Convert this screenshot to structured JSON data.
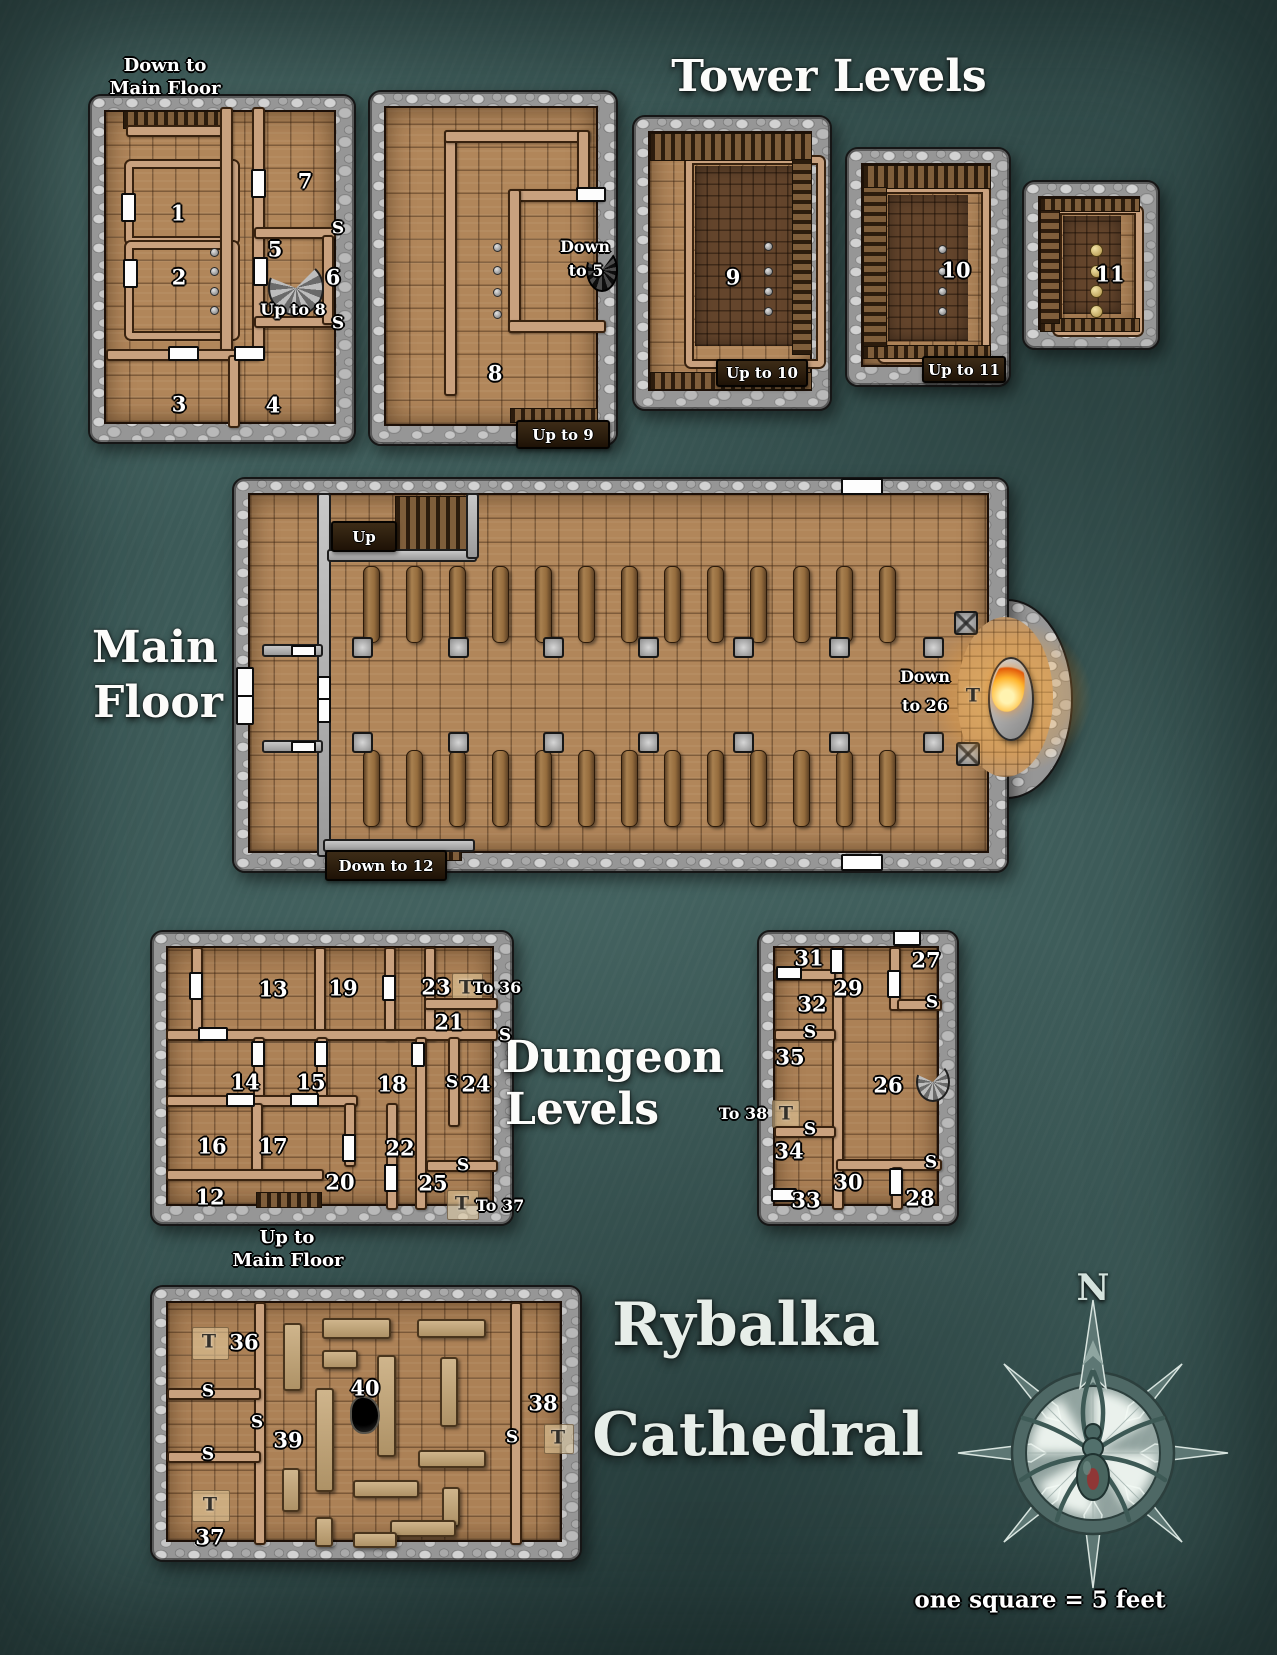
{
  "titles": {
    "tower_levels": "Tower Levels",
    "main_floor": [
      "Main",
      "Floor"
    ],
    "dungeon_levels": [
      "Dungeon",
      "Levels"
    ],
    "map_name": [
      "Rybalka",
      "Cathedral"
    ],
    "compass_north": "N",
    "scale_note": "one square = 5 feet"
  },
  "captions": {
    "tower1_above": [
      "Down to",
      "Main Floor"
    ],
    "dungeon_a_below": [
      "Up to",
      "Main Floor"
    ]
  },
  "banners": {
    "up": "Up",
    "down_to_12": "Down to 12",
    "up_to_9": "Up to 9",
    "up_to_10": "Up to 10",
    "up_to_11": "Up to 11"
  },
  "colors": {
    "background_teal": "#3c5a58",
    "stone_gray": "#969696",
    "floor_wood": "#b1865a",
    "interior_wall": "#c9a17e",
    "door_white": "#fdfdfd",
    "flame_orange": "#ffb52e"
  },
  "labels": [
    {
      "t": "1",
      "x": 178,
      "y": 213,
      "k": "num"
    },
    {
      "t": "2",
      "x": 179,
      "y": 277,
      "k": "num"
    },
    {
      "t": "3",
      "x": 179,
      "y": 404,
      "k": "num"
    },
    {
      "t": "4",
      "x": 273,
      "y": 405,
      "k": "num"
    },
    {
      "t": "5",
      "x": 275,
      "y": 249,
      "k": "num"
    },
    {
      "t": "6",
      "x": 333,
      "y": 277,
      "k": "num"
    },
    {
      "t": "7",
      "x": 305,
      "y": 181,
      "k": "num"
    },
    {
      "t": "Up to 8",
      "x": 293,
      "y": 310,
      "k": "cap"
    },
    {
      "t": "S",
      "x": 338,
      "y": 229,
      "k": "s"
    },
    {
      "t": "S",
      "x": 338,
      "y": 324,
      "k": "s"
    },
    {
      "t": "8",
      "x": 495,
      "y": 373,
      "k": "num"
    },
    {
      "t": "Down",
      "x": 585,
      "y": 247,
      "k": "cap"
    },
    {
      "t": "to 5",
      "x": 586,
      "y": 271,
      "k": "cap"
    },
    {
      "t": "9",
      "x": 733,
      "y": 277,
      "k": "num"
    },
    {
      "t": "10",
      "x": 956,
      "y": 270,
      "k": "num"
    },
    {
      "t": "11",
      "x": 1110,
      "y": 274,
      "k": "num"
    },
    {
      "t": "Down",
      "x": 925,
      "y": 677,
      "k": "cap"
    },
    {
      "t": "to 26",
      "x": 925,
      "y": 706,
      "k": "cap"
    },
    {
      "t": "T",
      "x": 973,
      "y": 696,
      "k": "t"
    },
    {
      "t": "13",
      "x": 273,
      "y": 989,
      "k": "num"
    },
    {
      "t": "19",
      "x": 343,
      "y": 988,
      "k": "num"
    },
    {
      "t": "23",
      "x": 436,
      "y": 987,
      "k": "num"
    },
    {
      "t": "T",
      "x": 466,
      "y": 988,
      "k": "t"
    },
    {
      "t": "To 36",
      "x": 497,
      "y": 988,
      "k": "cap"
    },
    {
      "t": "21",
      "x": 449,
      "y": 1022,
      "k": "num"
    },
    {
      "t": "S",
      "x": 505,
      "y": 1036,
      "k": "s"
    },
    {
      "t": "14",
      "x": 245,
      "y": 1082,
      "k": "num"
    },
    {
      "t": "15",
      "x": 311,
      "y": 1082,
      "k": "num"
    },
    {
      "t": "18",
      "x": 392,
      "y": 1084,
      "k": "num"
    },
    {
      "t": "S",
      "x": 452,
      "y": 1083,
      "k": "s"
    },
    {
      "t": "24",
      "x": 476,
      "y": 1084,
      "k": "num"
    },
    {
      "t": "16",
      "x": 212,
      "y": 1146,
      "k": "num"
    },
    {
      "t": "17",
      "x": 273,
      "y": 1146,
      "k": "num"
    },
    {
      "t": "22",
      "x": 400,
      "y": 1148,
      "k": "num"
    },
    {
      "t": "20",
      "x": 340,
      "y": 1182,
      "k": "num"
    },
    {
      "t": "25",
      "x": 433,
      "y": 1183,
      "k": "num"
    },
    {
      "t": "S",
      "x": 463,
      "y": 1166,
      "k": "s"
    },
    {
      "t": "12",
      "x": 210,
      "y": 1197,
      "k": "num"
    },
    {
      "t": "T",
      "x": 462,
      "y": 1204,
      "k": "t"
    },
    {
      "t": "To 37",
      "x": 500,
      "y": 1206,
      "k": "cap"
    },
    {
      "t": "31",
      "x": 809,
      "y": 958,
      "k": "num"
    },
    {
      "t": "27",
      "x": 926,
      "y": 960,
      "k": "num"
    },
    {
      "t": "29",
      "x": 848,
      "y": 988,
      "k": "num"
    },
    {
      "t": "32",
      "x": 812,
      "y": 1004,
      "k": "num"
    },
    {
      "t": "S",
      "x": 932,
      "y": 1003,
      "k": "s"
    },
    {
      "t": "S",
      "x": 810,
      "y": 1033,
      "k": "s"
    },
    {
      "t": "35",
      "x": 790,
      "y": 1057,
      "k": "num"
    },
    {
      "t": "26",
      "x": 888,
      "y": 1085,
      "k": "num"
    },
    {
      "t": "To 38",
      "x": 743,
      "y": 1114,
      "k": "cap"
    },
    {
      "t": "T",
      "x": 786,
      "y": 1114,
      "k": "t"
    },
    {
      "t": "S",
      "x": 810,
      "y": 1130,
      "k": "s"
    },
    {
      "t": "34",
      "x": 789,
      "y": 1151,
      "k": "num"
    },
    {
      "t": "30",
      "x": 848,
      "y": 1182,
      "k": "num"
    },
    {
      "t": "S",
      "x": 931,
      "y": 1163,
      "k": "s"
    },
    {
      "t": "33",
      "x": 806,
      "y": 1200,
      "k": "num"
    },
    {
      "t": "28",
      "x": 920,
      "y": 1198,
      "k": "num"
    },
    {
      "t": "T",
      "x": 209,
      "y": 1342,
      "k": "t"
    },
    {
      "t": "36",
      "x": 244,
      "y": 1342,
      "k": "num"
    },
    {
      "t": "S",
      "x": 208,
      "y": 1392,
      "k": "s"
    },
    {
      "t": "S",
      "x": 257,
      "y": 1423,
      "k": "s"
    },
    {
      "t": "39",
      "x": 288,
      "y": 1440,
      "k": "num"
    },
    {
      "t": "40",
      "x": 365,
      "y": 1388,
      "k": "num"
    },
    {
      "t": "S",
      "x": 208,
      "y": 1455,
      "k": "s"
    },
    {
      "t": "T",
      "x": 210,
      "y": 1505,
      "k": "t"
    },
    {
      "t": "37",
      "x": 210,
      "y": 1537,
      "k": "num"
    },
    {
      "t": "38",
      "x": 543,
      "y": 1403,
      "k": "num"
    },
    {
      "t": "S",
      "x": 512,
      "y": 1438,
      "k": "s"
    },
    {
      "t": "T",
      "x": 558,
      "y": 1438,
      "k": "t"
    }
  ]
}
